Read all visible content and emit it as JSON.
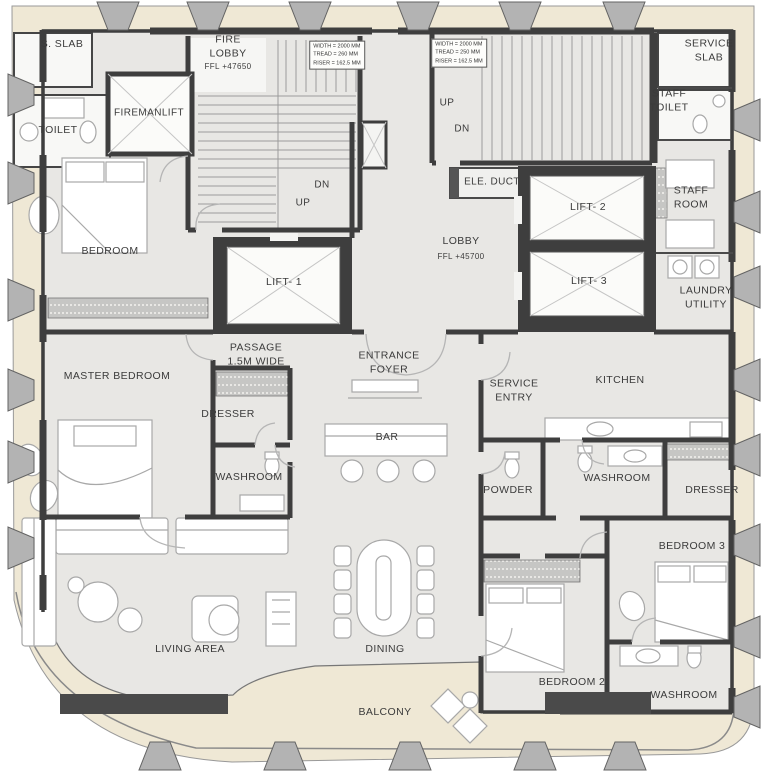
{
  "colors": {
    "wall": "#3E3E3E",
    "floor": "#E8E7E4",
    "balcony": "#EFE8D5",
    "column": "#B3B3B3",
    "paper": "#FFFFFF",
    "planter": "#4A4A4A"
  },
  "rooms": [
    {
      "id": "s-slab",
      "label": "S. SLAB",
      "x": 62,
      "y": 45
    },
    {
      "id": "fire-lobby",
      "label": "FIRE\nLOBBY",
      "x": 228,
      "y": 47
    },
    {
      "id": "fire-lobby-ffl",
      "label": "FFL +47650",
      "x": 228,
      "y": 67,
      "size": 8
    },
    {
      "id": "service-slab",
      "label": "SERVICE\nSLAB",
      "x": 709,
      "y": 51
    },
    {
      "id": "toilet",
      "label": "TOILET",
      "x": 58,
      "y": 131
    },
    {
      "id": "fireman-lift",
      "label": "FIREMANLIFT",
      "x": 149,
      "y": 113,
      "size": 10
    },
    {
      "id": "staff-toilet",
      "label": "STAFF\nTOILET",
      "x": 669,
      "y": 101
    },
    {
      "id": "up-right-stair",
      "label": "UP",
      "x": 447,
      "y": 103,
      "size": 10
    },
    {
      "id": "dn-right-stair",
      "label": "DN",
      "x": 462,
      "y": 129,
      "size": 10
    },
    {
      "id": "ele-duct",
      "label": "ELE. DUCT",
      "x": 492,
      "y": 182,
      "size": 10
    },
    {
      "id": "dn-left-stair",
      "label": "DN",
      "x": 322,
      "y": 185,
      "size": 10
    },
    {
      "id": "up-left-stair",
      "label": "UP",
      "x": 303,
      "y": 203,
      "size": 10
    },
    {
      "id": "lift-2",
      "label": "LIFT- 2",
      "x": 588,
      "y": 208
    },
    {
      "id": "staff-room",
      "label": "STAFF\nROOM",
      "x": 691,
      "y": 198
    },
    {
      "id": "bedroom",
      "label": "BEDROOM",
      "x": 110,
      "y": 252
    },
    {
      "id": "lobby",
      "label": "LOBBY",
      "x": 461,
      "y": 242
    },
    {
      "id": "lobby-ffl",
      "label": "FFL +45700",
      "x": 461,
      "y": 257,
      "size": 8
    },
    {
      "id": "lift-1",
      "label": "LIFT- 1",
      "x": 284,
      "y": 283
    },
    {
      "id": "lift-3",
      "label": "LIFT- 3",
      "x": 589,
      "y": 282
    },
    {
      "id": "laundry-utility",
      "label": "LAUNDRY\nUTILITY",
      "x": 706,
      "y": 298
    },
    {
      "id": "passage",
      "label": "PASSAGE\n1.5M WIDE",
      "x": 256,
      "y": 355
    },
    {
      "id": "entrance-foyer",
      "label": "ENTRANCE\nFOYER",
      "x": 389,
      "y": 363
    },
    {
      "id": "master-bedroom",
      "label": "MASTER BEDROOM",
      "x": 117,
      "y": 377
    },
    {
      "id": "service-entry",
      "label": "SERVICE\nENTRY",
      "x": 514,
      "y": 391
    },
    {
      "id": "kitchen",
      "label": "KITCHEN",
      "x": 620,
      "y": 381
    },
    {
      "id": "dresser-master",
      "label": "DRESSER",
      "x": 228,
      "y": 415
    },
    {
      "id": "bar",
      "label": "BAR",
      "x": 387,
      "y": 438
    },
    {
      "id": "washroom-master",
      "label": "WASHROOM",
      "x": 249,
      "y": 478
    },
    {
      "id": "powder",
      "label": "POWDER",
      "x": 508,
      "y": 491
    },
    {
      "id": "washroom-kitchen",
      "label": "WASHROOM",
      "x": 617,
      "y": 479
    },
    {
      "id": "dresser-bedroom3",
      "label": "DRESSER",
      "x": 712,
      "y": 491
    },
    {
      "id": "bedroom-3",
      "label": "BEDROOM 3",
      "x": 692,
      "y": 547
    },
    {
      "id": "living-area",
      "label": "LIVING AREA",
      "x": 190,
      "y": 650
    },
    {
      "id": "dining",
      "label": "DINING",
      "x": 385,
      "y": 650
    },
    {
      "id": "bedroom-2",
      "label": "BEDROOM 2",
      "x": 572,
      "y": 683
    },
    {
      "id": "washroom-bedroom2",
      "label": "WASHROOM",
      "x": 684,
      "y": 696
    },
    {
      "id": "balcony",
      "label": "BALCONY",
      "x": 385,
      "y": 713
    }
  ],
  "stair_specs": [
    {
      "x": 337,
      "y": 55,
      "lines": [
        "WIDTH = 2000 MM",
        "TREAD = 260 MM",
        "RISER = 162.5 MM"
      ]
    },
    {
      "x": 459,
      "y": 53,
      "lines": [
        "WIDTH = 2000 MM",
        "TREAD = 250 MM",
        "RISER = 162.5 MM"
      ]
    }
  ]
}
